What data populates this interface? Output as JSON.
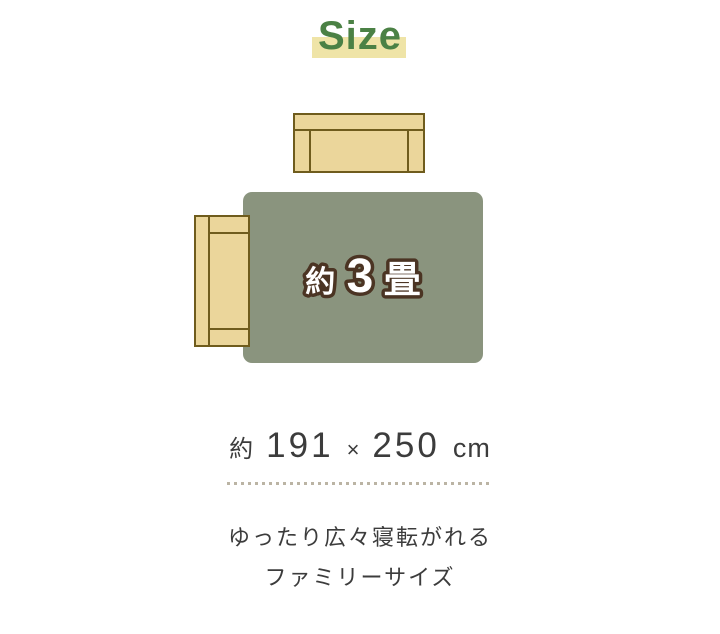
{
  "title": "Size",
  "colors": {
    "title_green": "#4b8145",
    "highlight": "#efe4a7",
    "rug": "#8a947e",
    "sofa_fill": "#ebd69b",
    "sofa_border": "#6f5c1d",
    "label_stroke": "#4b3423",
    "label_fill": "#ffffff",
    "text": "#3c3c3c",
    "dots": "#bbb4a4"
  },
  "diagram": {
    "rug_label": {
      "prefix": "約",
      "number": "3",
      "unit": "畳"
    }
  },
  "dimension": {
    "prefix": "約",
    "width": "191",
    "times": "×",
    "length": "250",
    "unit": "cm"
  },
  "caption": {
    "line1": "ゆったり広々寝転がれる",
    "line2": "ファミリーサイズ"
  }
}
